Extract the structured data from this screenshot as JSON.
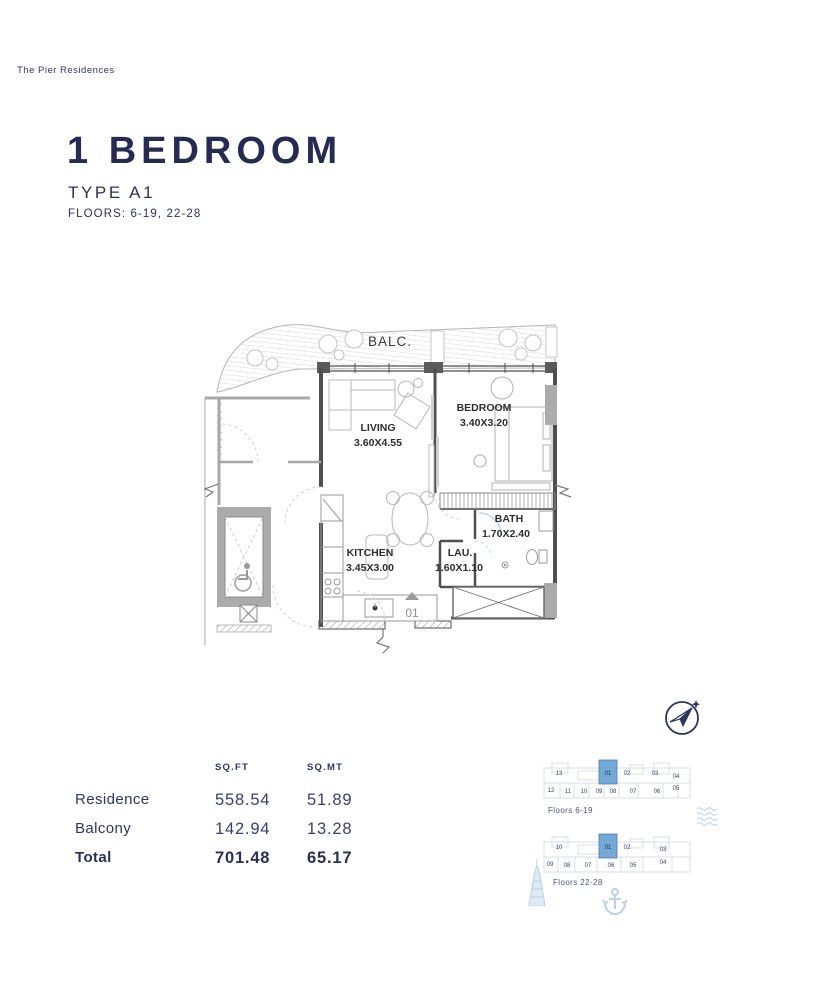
{
  "brand": "The Pier Residences",
  "title": {
    "heading": "1 BEDROOM",
    "type": "TYPE A1",
    "floors": "FLOORS: 6-19, 22-28"
  },
  "plan": {
    "balcony_label": "BALC.",
    "unit_number": "01",
    "rooms": [
      {
        "name": "LIVING",
        "dims": "3.60X4.55"
      },
      {
        "name": "BEDROOM",
        "dims": "3.40X3.20"
      },
      {
        "name": "KITCHEN",
        "dims": "3.45X3.00"
      },
      {
        "name": "BATH",
        "dims": "1.70X2.40"
      },
      {
        "name": "LAU.",
        "dims": "1.60X1.10"
      }
    ]
  },
  "area_table": {
    "columns": [
      "SQ.FT",
      "SQ.MT"
    ],
    "rows": [
      {
        "label": "Residence",
        "sqft": "558.54",
        "sqmt": "51.89"
      },
      {
        "label": "Balcony",
        "sqft": "142.94",
        "sqmt": "13.28"
      },
      {
        "label": "Total",
        "sqft": "701.48",
        "sqmt": "65.17"
      }
    ]
  },
  "keyplans": [
    {
      "label": "Floors 6-19",
      "highlighted_unit": "01",
      "top_row": [
        "13",
        "01",
        "02",
        "03",
        "04"
      ],
      "bottom_row": [
        "12",
        "11",
        "10",
        "09",
        "08",
        "07",
        "06",
        "05"
      ]
    },
    {
      "label": "Floors 22-28",
      "highlighted_unit": "01",
      "top_row": [
        "10",
        "01",
        "02",
        "03"
      ],
      "bottom_row": [
        "09",
        "08",
        "07",
        "06",
        "05",
        "04"
      ]
    }
  ],
  "icons": {
    "compass": "north-arrow-paper-plane",
    "waves": "sea-waves",
    "tower": "landmark-tower",
    "anchor": "anchor"
  },
  "colors": {
    "navy": "#272c55",
    "highlight_blue": "#72a9d7",
    "light_blue": "#bcd4ea",
    "plan_line": "#4f4f4f"
  }
}
